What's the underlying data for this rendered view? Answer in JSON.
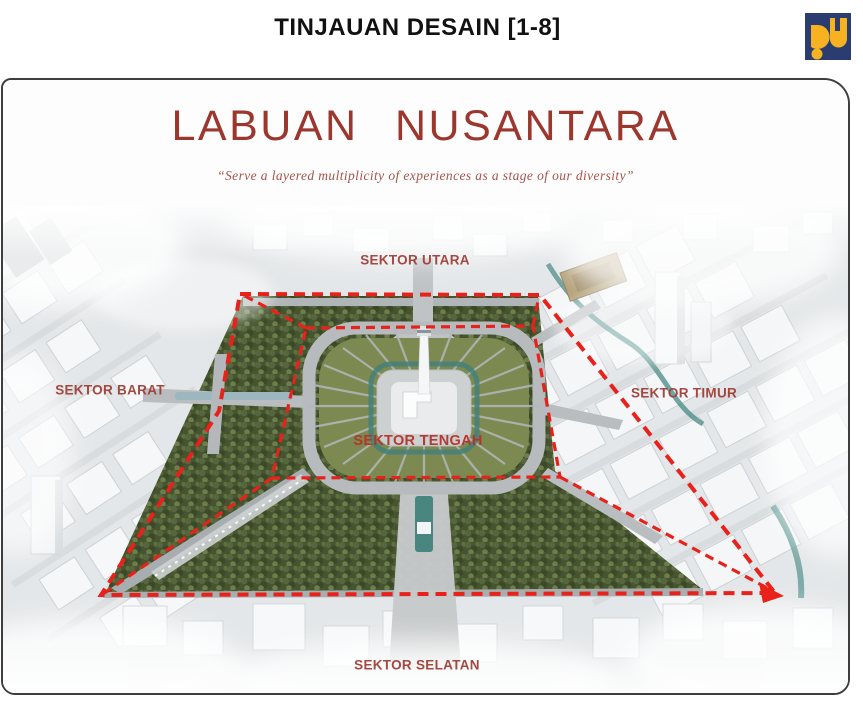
{
  "header": {
    "title": "TINJAUAN DESAIN [1-8]"
  },
  "logo": {
    "name": "pupr-logo",
    "blue": "#2a3c70",
    "yellow": "#f6b221"
  },
  "slide": {
    "title": "LABUAN NUSANTARA",
    "subtitle": "“Serve a layered multiplicity of experiences as a stage of our diversity”"
  },
  "map": {
    "type": "annotated-aerial-masterplan",
    "sectors": [
      {
        "id": "utara",
        "label": "SEKTOR UTARA"
      },
      {
        "id": "barat",
        "label": "SEKTOR BARAT"
      },
      {
        "id": "timur",
        "label": "SEKTOR TIMUR"
      },
      {
        "id": "tengah",
        "label": "SEKTOR TENGAH"
      },
      {
        "id": "selatan",
        "label": "SEKTOR SELATAN"
      }
    ],
    "overlay": {
      "boundary_color": "#e8211a",
      "style": "dashed"
    }
  },
  "colors": {
    "title_red": "#9c372e",
    "subtitle_red": "#a5544b",
    "label_red": "#9e3a33",
    "dash_red": "#e8211a",
    "frame_border": "#3e3e3e"
  }
}
